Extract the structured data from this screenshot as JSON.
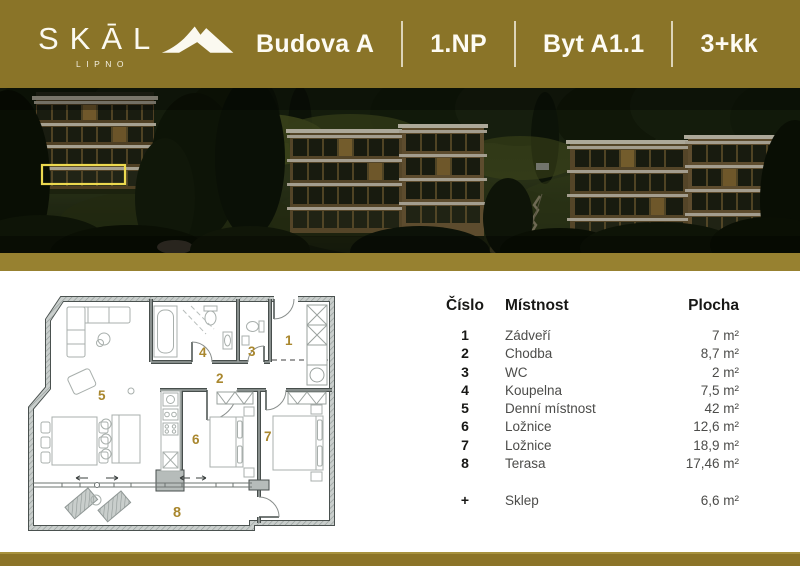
{
  "brand": {
    "name": "SKĀL",
    "sub": "LIPNO"
  },
  "header": {
    "items": [
      "Budova A",
      "1.NP",
      "Byt A1.1",
      "3+kk"
    ]
  },
  "floorplan": {
    "numbers": [
      "1",
      "2",
      "3",
      "4",
      "5",
      "6",
      "7",
      "8"
    ]
  },
  "table": {
    "headers": [
      "Číslo",
      "Místnost",
      "Plocha"
    ],
    "rows": [
      {
        "num": "1",
        "name": "Zádveří",
        "area": "7 m²"
      },
      {
        "num": "2",
        "name": "Chodba",
        "area": "8,7 m²"
      },
      {
        "num": "3",
        "name": "WC",
        "area": "2 m²"
      },
      {
        "num": "4",
        "name": "Koupelna",
        "area": "7,5 m²"
      },
      {
        "num": "5",
        "name": "Denní místnost",
        "area": "42 m²"
      },
      {
        "num": "6",
        "name": "Ložnice",
        "area": "12,6 m²"
      },
      {
        "num": "7",
        "name": "Ložnice",
        "area": "18,9 m²"
      },
      {
        "num": "8",
        "name": "Terasa",
        "area": "17,46 m²"
      }
    ],
    "extra": {
      "num": "+",
      "name": "Sklep",
      "area": "6,6 m²"
    }
  },
  "colors": {
    "gold": "#8a7428",
    "band": "#978130",
    "accent_number": "#a9872e",
    "highlight": "#ecd94f"
  }
}
